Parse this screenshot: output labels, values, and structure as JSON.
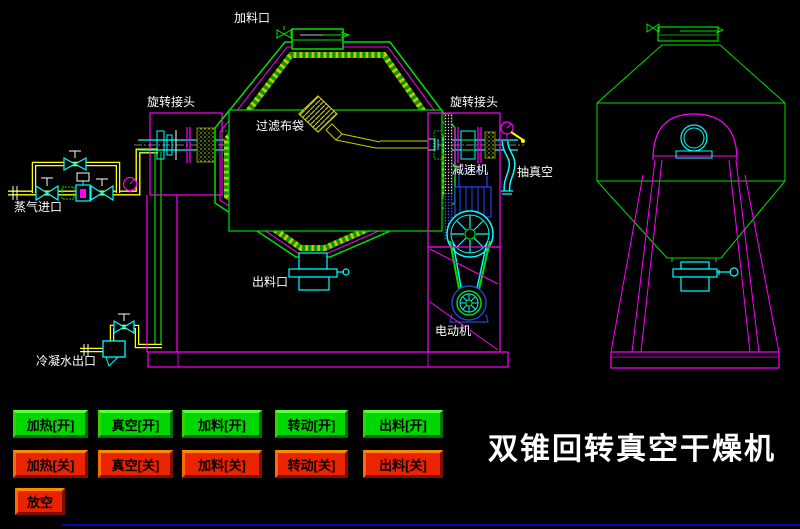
{
  "title": "双锥回转真空干燥机",
  "diagram": {
    "labels": {
      "feed_port": "加料口",
      "rotary_joint_left": "旋转接头",
      "filter_bag": "过滤布袋",
      "rotary_joint_right": "旋转接头",
      "steam_inlet": "蒸气进口",
      "reducer": "减速机",
      "vacuum_suction": "抽真空",
      "discharge_port": "出料口",
      "motor": "电动机",
      "condensate_outlet": "冷凝水出口"
    }
  },
  "controls": {
    "on_buttons": [
      {
        "label": "加热[开]"
      },
      {
        "label": "真空[开]"
      },
      {
        "label": "加料[开]"
      },
      {
        "label": "转动[开]"
      },
      {
        "label": "出料[开]"
      }
    ],
    "off_buttons": [
      {
        "label": "加热[关]"
      },
      {
        "label": "真空[关]"
      },
      {
        "label": "加料[关]"
      },
      {
        "label": "转动[关]"
      },
      {
        "label": "出料[关]"
      }
    ],
    "vent_button": {
      "label": "放空"
    }
  },
  "colors": {
    "background": "#000000",
    "line_green": "#00e000",
    "line_magenta": "#ff00ff",
    "line_cyan": "#00ffff",
    "line_yellow": "#ffff00",
    "line_blue": "#2244dd",
    "label_white": "#ffffff",
    "button_on_green": "#00d600",
    "button_off_red": "#ea2300",
    "footer_blue": "#0008bb"
  }
}
